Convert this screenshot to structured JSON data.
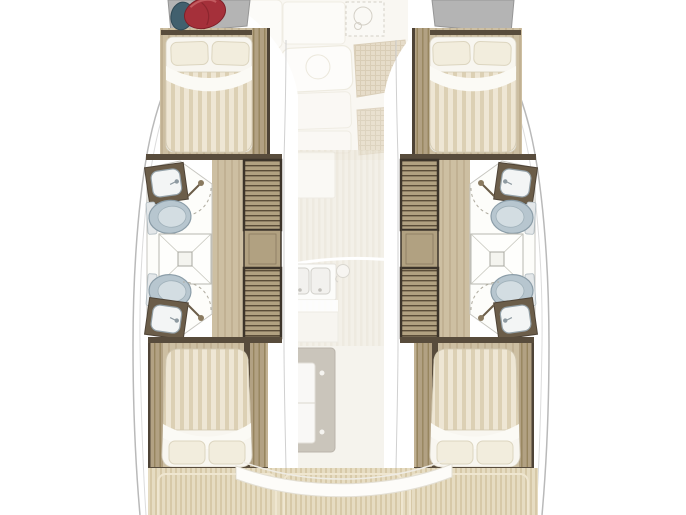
{
  "meta": {
    "kind": "yacht-floorplan-diagram",
    "subject": "catamaran interior deck plan, bow at top, two symmetric hulls with ghosted upper-deck overlay in the centre",
    "width": 686,
    "height": 515
  },
  "palette": {
    "hull_fill": "#ffffff",
    "hull_stroke": "#b9b9b9",
    "sheer_line": "#dcdcdc",
    "wall_dark": "#584c3c",
    "wall_edge": "#4e4336",
    "wood_base": "#cdbfa2",
    "wood_stripe": "#c1b193",
    "plank_base": "#b2a183",
    "plank_stripe": "#97855f",
    "stair_base": "#b1a181",
    "stair_line": "#5a4c38",
    "stair_frame": "#3c342a",
    "duvet_base": "#eee6d4",
    "duvet_stripe": "#dcd0b4",
    "mattress": "#f8f6f0",
    "pillow": "#f2eddd",
    "pillow_edge": "#dcd5bf",
    "sheet": "#fbfaf5",
    "bath_floor": "#fdfdfa",
    "bath_edge": "#c7c6c0",
    "fixture_edge": "#8b9da8",
    "toilet_fill": "#b7c6cf",
    "toilet_seat": "#d3dde2",
    "basin_fill": "#f3f5f5",
    "counter_dark": "#6b5d49",
    "bow_pad": "#b4b4b4",
    "bow_pad_edge": "#969696",
    "bag_red": "#a5303a",
    "bag_red_edge": "#7e2028",
    "bag_teal": "#41606e",
    "ghost_ivory": "#f6f3eb",
    "ghost_panel": "#fbf9f4",
    "ghost_edge": "#e6e1d2",
    "wicker_base": "#d7c6a6",
    "wicker_line": "#c1ad87",
    "ghostwood_base": "#ece7da",
    "ghostwood_stripe": "#e4ddcc",
    "teak_base": "#e6dcc2",
    "teak_stripe": "#d7c9a8",
    "teak_panel_line": "#efe6d0",
    "table_grey": "#b9b2a5",
    "table_grey_edge": "#a39c8f"
  },
  "vessel": {
    "type": "catamaran",
    "hulls": [
      {
        "side": "port",
        "rooms": [
          "forward-double-cabin",
          "forward-head",
          "central-shower",
          "aft-head",
          "aft-double-cabin"
        ],
        "fixtures": [
          "bed-with-two-pillows",
          "sink",
          "toilet",
          "shower-drain",
          "companionway-stairs",
          "landing",
          "shower-wand"
        ]
      },
      {
        "side": "starboard",
        "rooms": [
          "forward-double-cabin",
          "forward-head",
          "central-shower",
          "aft-head",
          "aft-double-cabin"
        ],
        "fixtures": [
          "bed-with-two-pillows",
          "sink",
          "toilet",
          "shower-drain",
          "companionway-stairs",
          "landing",
          "shower-wand"
        ]
      }
    ],
    "deck_ghost": {
      "bow_items": [
        "red-sail-bag",
        "teal-fender",
        "grey-bow-pads",
        "liferaft-dashed-locker"
      ],
      "saloon_items": [
        "saloon-table-with-cup-circle",
        "bench-seats",
        "wicker-sunpads"
      ],
      "galley_items": [
        "upper-counter",
        "double-sink",
        "kettle",
        "counter-band"
      ],
      "cockpit_items": [
        "grey-cockpit-table-with-slatted-leaf",
        "storage-units",
        "curved-transom-bench",
        "teak-deck-panels"
      ]
    }
  }
}
